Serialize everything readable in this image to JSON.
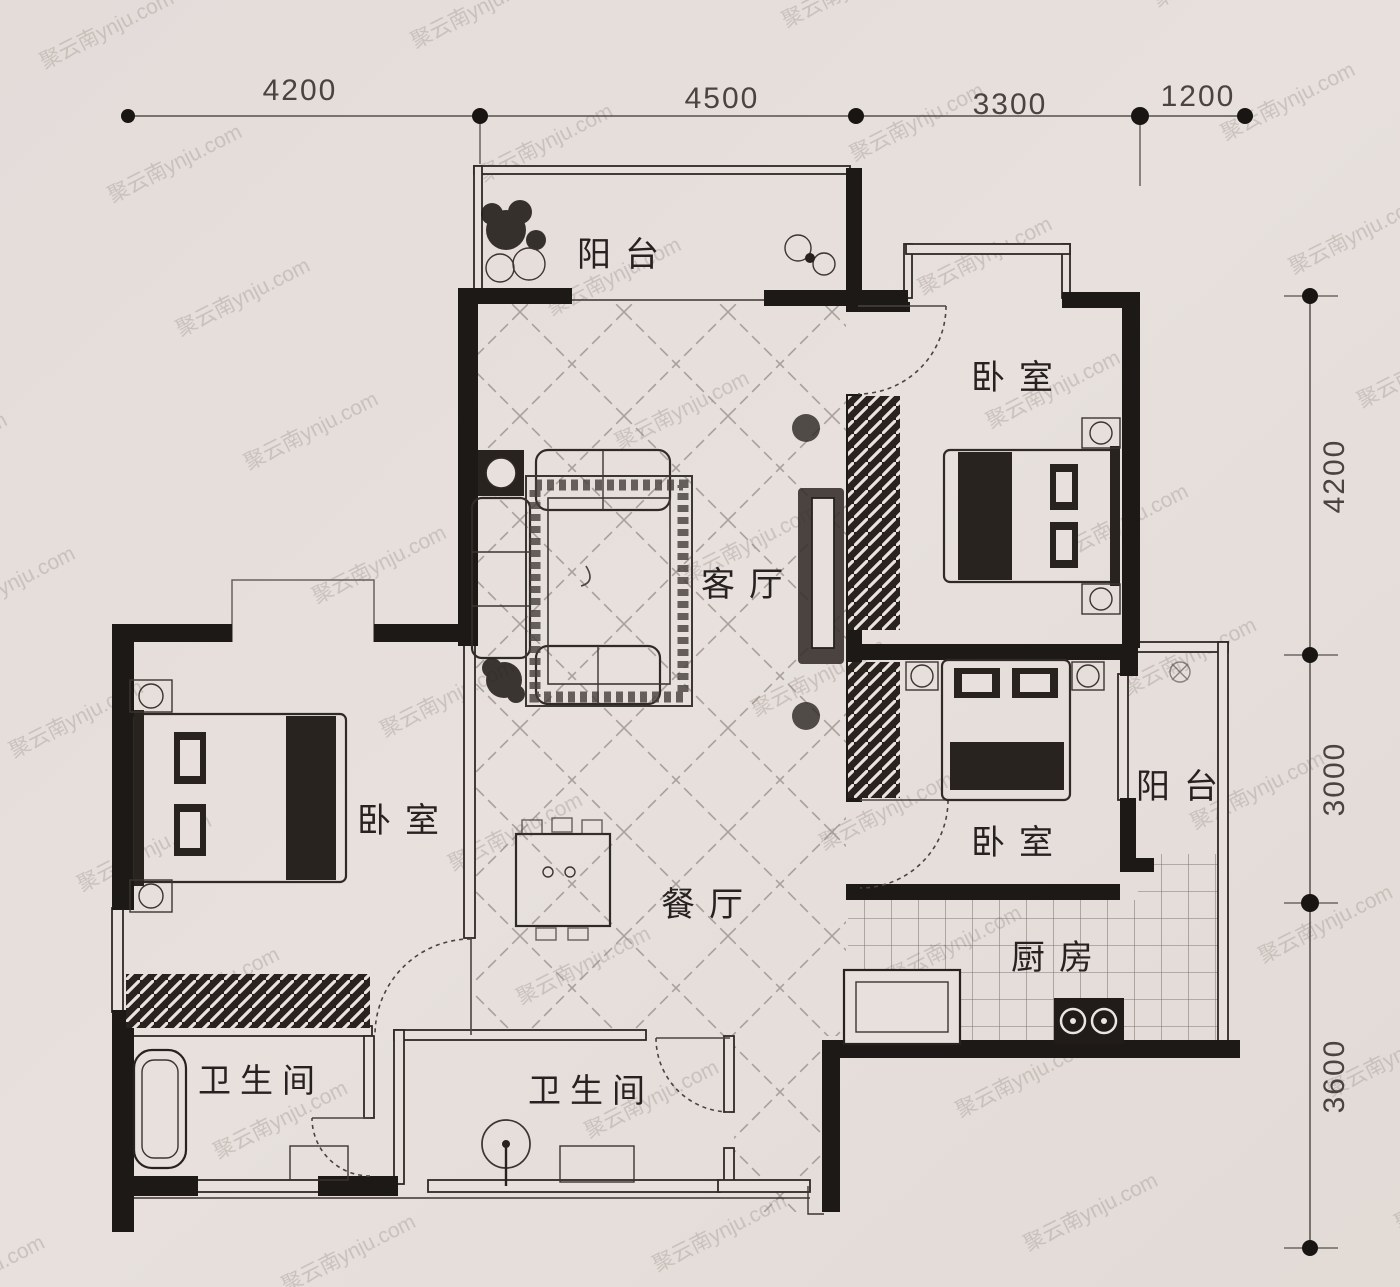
{
  "watermark": "聚云南ynju.com",
  "dimensions": {
    "top": [
      "4200",
      "4500",
      "3300",
      "1200"
    ],
    "right": [
      "4200",
      "3000",
      "3600"
    ]
  },
  "rooms": {
    "balcony_top": "阳台",
    "bedroom_top_right": "卧室",
    "living": "客厅",
    "bedroom_left": "卧室",
    "bedroom_mid_right": "卧室",
    "balcony_right": "阳台",
    "dining": "餐厅",
    "kitchen": "厨房",
    "bathroom_left": "卫生间",
    "bathroom_mid": "卫生间"
  },
  "colors": {
    "paper": "#ebe5e1",
    "ink": "#1b1816",
    "lattice": "#968e88",
    "grid": "#6d6660",
    "dim_text": "#4a4440",
    "watermark": "#a89f99"
  }
}
